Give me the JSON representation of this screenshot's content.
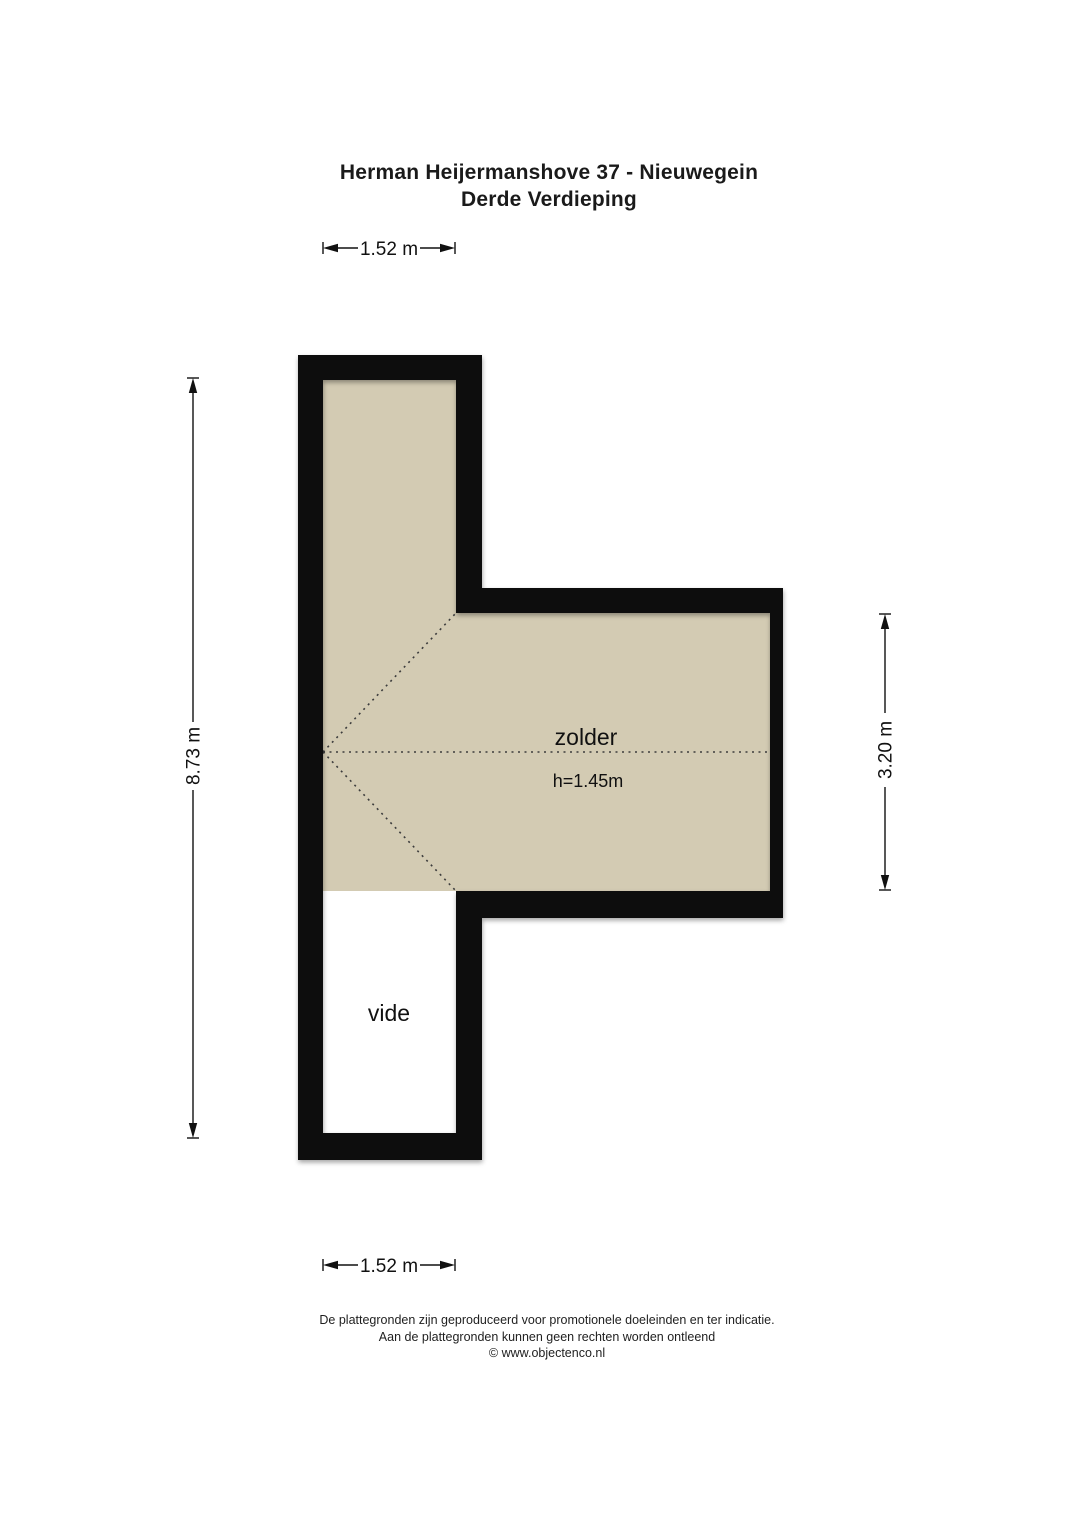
{
  "title": {
    "line1": "Herman Heijermanshove 37 - Nieuwegein",
    "line2": "Derde Verdieping"
  },
  "plan": {
    "rooms": [
      {
        "name": "zolder",
        "label": "zolder",
        "height_note": "h=1.45m"
      },
      {
        "name": "vide",
        "label": "vide"
      }
    ],
    "dimensions": {
      "top": "1.52 m",
      "bottom": "1.52 m",
      "left": "8.73 m",
      "right": "3.20 m"
    }
  },
  "footer": {
    "line1": "De plattegronden zijn geproduceerd voor promotionele doeleinden en ter indicatie.",
    "line2": "Aan de plattegronden kunnen geen rechten worden ontleend",
    "line3": "© www.objectenco.nl"
  },
  "colors": {
    "wall": "#0b0b0b",
    "room_fill": "#d3cbb3",
    "vide_fill": "#ffffff",
    "background": "#ffffff"
  }
}
